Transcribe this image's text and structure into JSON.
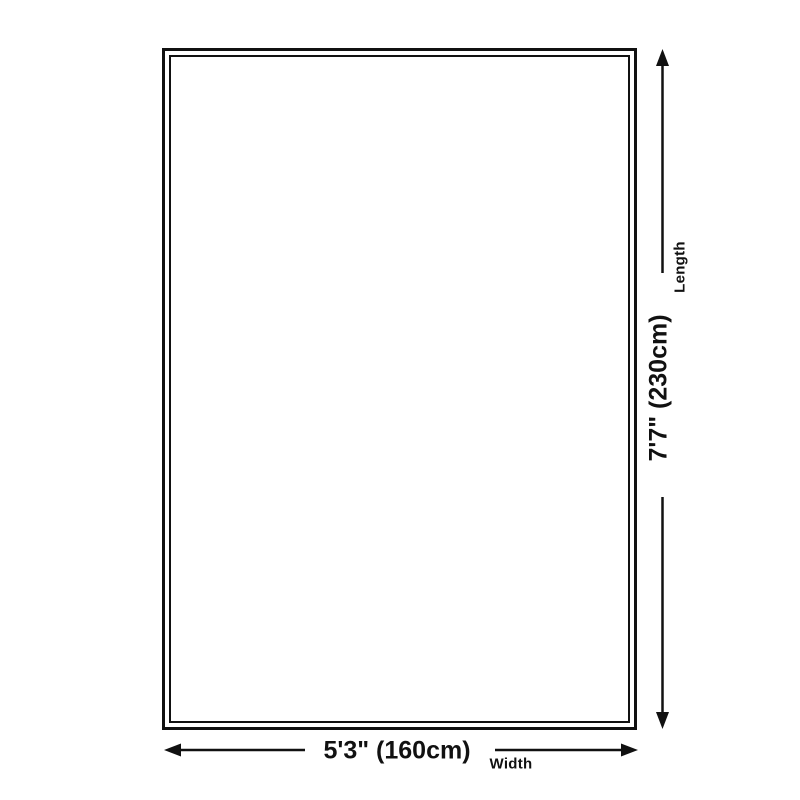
{
  "page": {
    "background_color": "#ffffff",
    "ink_color": "#111111"
  },
  "diagram": {
    "type": "product-size-diagram",
    "shape": "rectangle-double-outline",
    "length": {
      "value": "7'7\" (230cm)",
      "label": "Length",
      "orientation": "vertical",
      "arrow": "double-headed-vertical-arrow"
    },
    "width": {
      "value": "5'3\" (160cm)",
      "label": "Width",
      "orientation": "horizontal",
      "arrow": "double-headed-horizontal-arrow"
    }
  }
}
